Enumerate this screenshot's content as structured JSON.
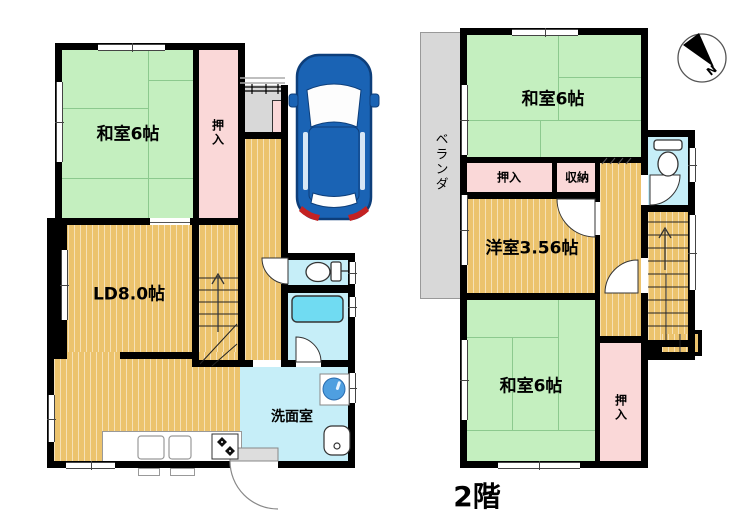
{
  "floor1": {
    "washitsu": "和室6帖",
    "oshiire": "押入",
    "ld": "LD8.0帖",
    "senmenshitsu": "洗面室"
  },
  "floor2": {
    "washitsu_north": "和室6帖",
    "oshiire_north": "押入",
    "shuunou": "収納",
    "youshitsu": "洋室3.56帖",
    "washitsu_south": "和室6帖",
    "oshiire_south": "押入",
    "veranda": "ベランダ",
    "floor_label": "2階"
  },
  "compass": {
    "north": "N"
  },
  "icons": [
    "toilet-icon",
    "bathtub-icon",
    "washing-machine-icon",
    "sink-icon",
    "kitchen-sink-icon",
    "stove-icon",
    "stairs-up-arrow",
    "car-top-view",
    "north-compass"
  ],
  "colors": {
    "wall": "#000000",
    "tatami_green": "#c4efbf",
    "wood_floor": "#ecc36d",
    "closet_pink": "#fad8d8",
    "wet_area_cyan": "#c6eef8",
    "bathtub_cyan": "#70dbf2",
    "veranda_gray": "#d8d8d8",
    "car_blue": "#1a63b4"
  }
}
